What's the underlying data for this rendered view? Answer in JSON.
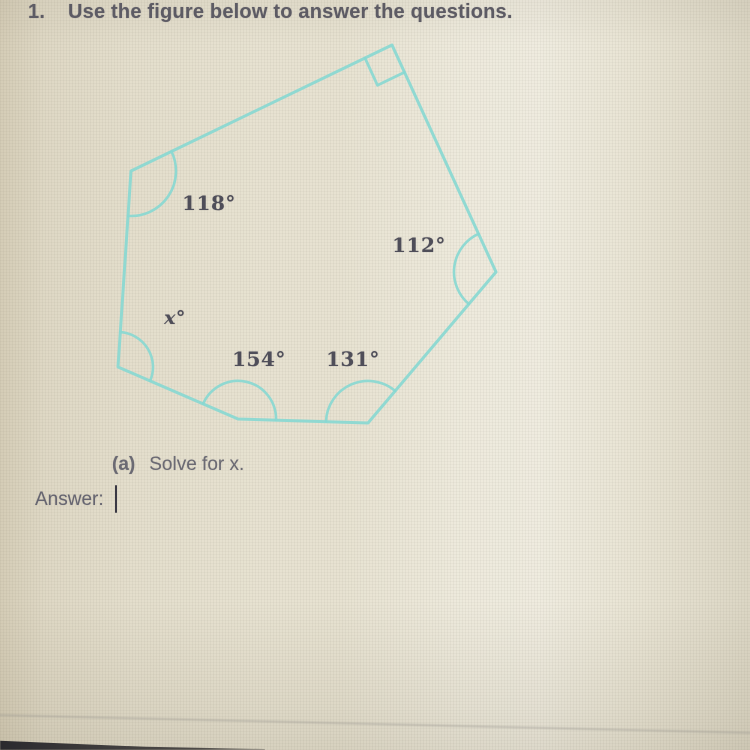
{
  "colors": {
    "figure_stroke": "#89d8d1",
    "heading_text": "#5d5b64",
    "body_text": "#6b6a73",
    "angle_label_text": "#4f4e59"
  },
  "question": {
    "number": "1.",
    "prompt": "Use the figure below to answer the questions."
  },
  "figure": {
    "shape": "irregular hexagon",
    "labels": {
      "a118": "118°",
      "a112": "112°",
      "ax": "x°",
      "a154": "154°",
      "a131": "131°"
    }
  },
  "part_a": {
    "label": "(a)",
    "text": "Solve for x."
  },
  "answer": {
    "label": "Answer:",
    "value": ""
  }
}
